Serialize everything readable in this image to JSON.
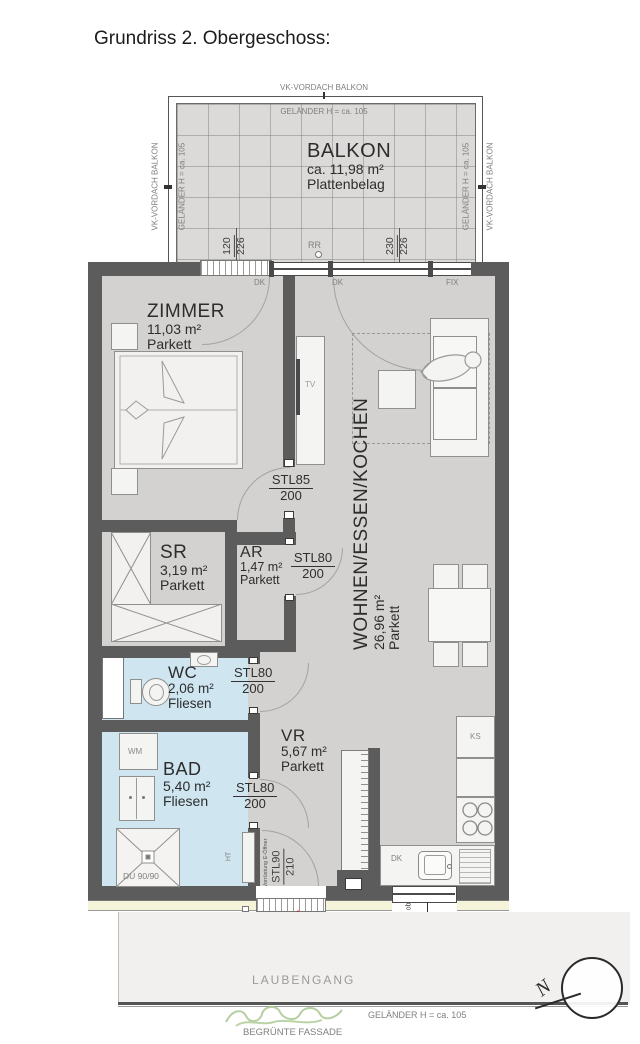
{
  "title": "Grundriss 2. Obergeschoss:",
  "balcony": {
    "vordach": "VK-VORDACH BALKON",
    "gelaender": "GELÄNDER H = ca. 105",
    "name": "BALKON",
    "area": "ca. 11,98 m²",
    "floor": "Plattenbelag",
    "dim1_num": "120",
    "dim1_den": "226",
    "dim2_num": "230",
    "dim2_den": "226",
    "rr": "RR"
  },
  "windows": {
    "dk": "DK",
    "fix": "FIX"
  },
  "rooms": {
    "zimmer": {
      "name": "ZIMMER",
      "area": "11,03 m²",
      "floor": "Parkett"
    },
    "wohnen": {
      "name": "WOHNEN/ESSEN/KOCHEN",
      "area": "26,96 m²",
      "floor": "Parkett"
    },
    "sr": {
      "name": "SR",
      "area": "3,19 m²",
      "floor": "Parkett"
    },
    "ar": {
      "name": "AR",
      "area": "1,47 m²",
      "floor": "Parkett"
    },
    "wc": {
      "name": "WC",
      "area": "2,06 m²",
      "floor": "Fliesen"
    },
    "bad": {
      "name": "BAD",
      "area": "5,40 m²",
      "floor": "Fliesen"
    },
    "vr": {
      "name": "VR",
      "area": "5,67 m²",
      "floor": "Parkett"
    }
  },
  "doors": {
    "stl85": {
      "num": "STL85",
      "den": "200"
    },
    "stl80": {
      "num": "STL80",
      "den": "200"
    },
    "stl90": {
      "num": "STL90",
      "den": "210"
    },
    "e_opener": "Vorrüstung E-Öffner"
  },
  "fixtures": {
    "tv": "TV",
    "wm": "WM",
    "ht": "HT",
    "ks": "KS",
    "shower": "DU 90/90"
  },
  "bottom": {
    "rr": "RR",
    "unit": "A09",
    "dim_prefix": "ob",
    "dim_a": "100",
    "dim_b": "70",
    "laubengang": "LAUBENGANG",
    "gelaender": "GELÄNDER H = ca. 105",
    "fassade": "BEGRÜNTE FASSADE",
    "north": "N"
  },
  "colors": {
    "wall": "#5c5c5c",
    "floor": "#d3d2d0",
    "wet_floor": "#cfe6f1",
    "cream": "#f5f3d9",
    "red": "#c1272d"
  }
}
